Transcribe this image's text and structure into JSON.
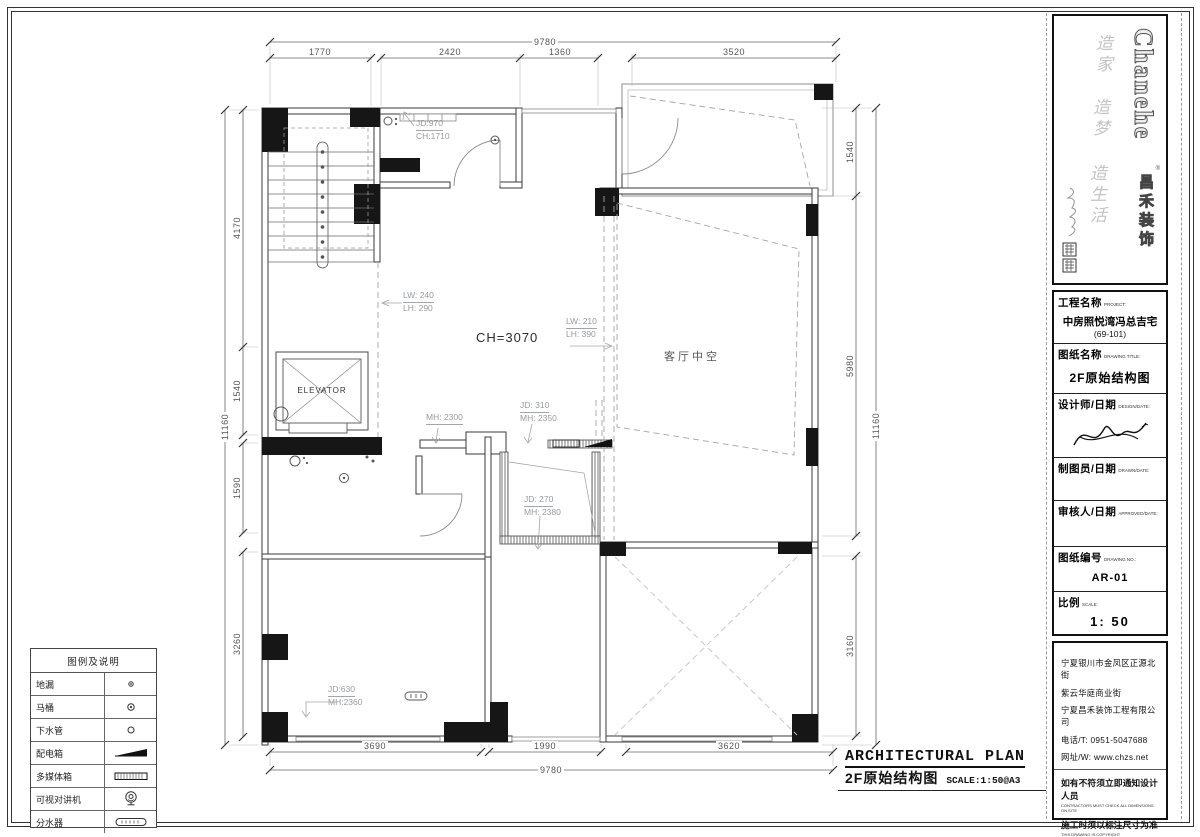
{
  "meta": {
    "sheet_title": "ARCHITECTURAL PLAN",
    "sheet_subtitle": "2F原始结构图",
    "sheet_scale_note": "SCALE:1:50@A3"
  },
  "logo": {
    "brand_en": "Chanehe",
    "brand_reg": "®",
    "brand_cn": "昌禾装饰",
    "slogan1": "造家",
    "slogan2": "造梦",
    "slogan3": "造生活"
  },
  "title_block": {
    "project_label": "工程名称",
    "project_label_en": "PROJECT:",
    "project_name": "中房照悦湾冯总吉宅",
    "project_no": "(69-101)",
    "drawing_title_label": "图纸名称",
    "drawing_title_label_en": "DRAWING TITLE:",
    "drawing_title": "2F原始结构图",
    "designer_label": "设计师/日期",
    "designer_label_en": "DESIGN/DATE:",
    "drafter_label": "制图员/日期",
    "drafter_label_en": "DRAWN/DATE:",
    "approver_label": "审核人/日期",
    "approver_label_en": "APPROVED/DATE:",
    "drawing_no_label": "图纸编号",
    "drawing_no_label_en": "DRAWING NO.:",
    "drawing_no": "AR-01",
    "scale_label": "比例",
    "scale_label_en": "SCALE:",
    "scale_value": "1: 50"
  },
  "company": {
    "address1": "宁夏银川市金凤区正源北街",
    "address2": "紫云华庭商业街",
    "name": "宁夏昌禾装饰工程有限公司",
    "phone": "电话/T: 0951-5047688",
    "web": "网址/W: www.chzs.net",
    "note1": "如有不符须立即通知设计人员",
    "note1_en": "CONTRACTORS MUST CHECK ALL DIMENSIONS ON SITE",
    "note2": "施工时须以标注尺寸为准",
    "note2_en": "THIS DRAWING IS COPYRIGHT"
  },
  "legend": {
    "title": "图例及说明",
    "rows": [
      {
        "label": "地漏",
        "symbol": "floor-drain"
      },
      {
        "label": "马桶",
        "symbol": "toilet"
      },
      {
        "label": "下水管",
        "symbol": "drain-pipe"
      },
      {
        "label": "配电箱",
        "symbol": "distribution-box"
      },
      {
        "label": "多媒体箱",
        "symbol": "multimedia-box"
      },
      {
        "label": "可视对讲机",
        "symbol": "video-intercom"
      },
      {
        "label": "分水器",
        "symbol": "water-manifold"
      }
    ]
  },
  "plan": {
    "room_labels": {
      "elevator": "ELEVATOR",
      "living_void": "客厅中空",
      "ceiling_height": "CH=3070"
    },
    "annotations": {
      "jd970": {
        "l1": "JD:970",
        "l2": "CH:1710"
      },
      "lw240": {
        "l1": "LW: 240",
        "l2": "LH: 290"
      },
      "lw210": {
        "l1": "LW: 210",
        "l2": "LH: 390"
      },
      "mh2300": {
        "l1": "MH: 2300"
      },
      "jd310": {
        "l1": "JD: 310",
        "l2": "MH: 2350"
      },
      "jd270": {
        "l1": "JD: 270",
        "l2": "MH: 2380"
      },
      "jd630": {
        "l1": "JD:630",
        "l2": "MH:2360"
      }
    },
    "dimensions": {
      "top": {
        "overall": "9780",
        "segments": [
          "1770",
          "2420",
          "1360",
          "3520"
        ]
      },
      "bottom": {
        "overall": "9780",
        "segments": [
          "3690",
          "1990",
          "3620"
        ]
      },
      "left": {
        "overall": "11160",
        "segments": [
          "4170",
          "1540",
          "1590",
          "3260"
        ]
      },
      "right": {
        "overall": "11160",
        "segments": [
          "1540",
          "5980",
          "3160"
        ]
      }
    }
  }
}
